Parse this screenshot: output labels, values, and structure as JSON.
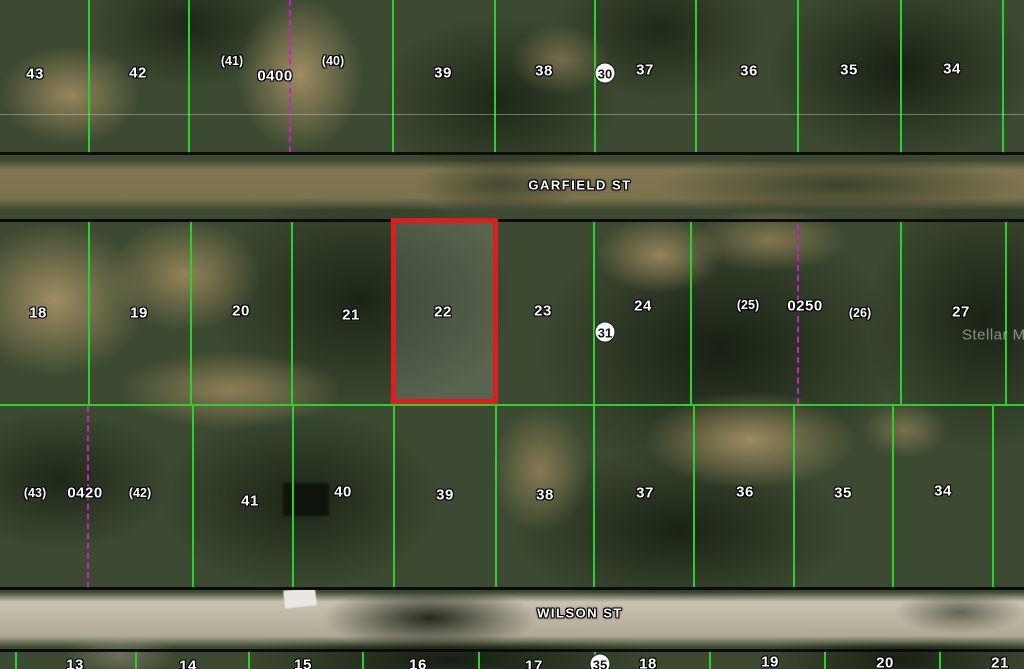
{
  "map": {
    "colors": {
      "parcel_line_green": "#2ccf2b",
      "survey_line_magenta": "#cf1ecb",
      "highlight_red": "#de1e1e",
      "street_line_black": "#0c0c0c"
    },
    "streets": [
      {
        "name": "GARFIELD ST"
      },
      {
        "name": "WILSON ST"
      }
    ],
    "watermark": {
      "text": "Stellar MLS"
    },
    "highlight": {
      "label": "22",
      "x": 391,
      "y": 218,
      "w": 107,
      "h": 186
    },
    "labels": {
      "top_row": [
        {
          "text": "43",
          "x": 35,
          "y": 74
        },
        {
          "text": "42",
          "x": 138,
          "y": 73
        },
        {
          "text": "(41)",
          "x": 232,
          "y": 61
        },
        {
          "text": "0400",
          "x": 275,
          "y": 76
        },
        {
          "text": "(40)",
          "x": 333,
          "y": 61
        },
        {
          "text": "39",
          "x": 443,
          "y": 73
        },
        {
          "text": "38",
          "x": 544,
          "y": 71
        },
        {
          "text": "30",
          "x": 605,
          "y": 73,
          "circled": true
        },
        {
          "text": "37",
          "x": 645,
          "y": 70
        },
        {
          "text": "36",
          "x": 749,
          "y": 71
        },
        {
          "text": "35",
          "x": 849,
          "y": 70
        },
        {
          "text": "34",
          "x": 952,
          "y": 69
        }
      ],
      "middle_row": [
        {
          "text": "18",
          "x": 38,
          "y": 313
        },
        {
          "text": "19",
          "x": 139,
          "y": 313
        },
        {
          "text": "20",
          "x": 241,
          "y": 311
        },
        {
          "text": "21",
          "x": 351,
          "y": 315
        },
        {
          "text": "22",
          "x": 443,
          "y": 312
        },
        {
          "text": "23",
          "x": 543,
          "y": 311
        },
        {
          "text": "31",
          "x": 605,
          "y": 332,
          "circled": true
        },
        {
          "text": "24",
          "x": 643,
          "y": 306
        },
        {
          "text": "(25)",
          "x": 748,
          "y": 305
        },
        {
          "text": "0250",
          "x": 805,
          "y": 306
        },
        {
          "text": "(26)",
          "x": 860,
          "y": 313
        },
        {
          "text": "27",
          "x": 961,
          "y": 312
        }
      ],
      "lower_row": [
        {
          "text": "(43)",
          "x": 35,
          "y": 493
        },
        {
          "text": "0420",
          "x": 85,
          "y": 493
        },
        {
          "text": "(42)",
          "x": 140,
          "y": 493
        },
        {
          "text": "41",
          "x": 250,
          "y": 501
        },
        {
          "text": "40",
          "x": 343,
          "y": 492
        },
        {
          "text": "39",
          "x": 445,
          "y": 495
        },
        {
          "text": "38",
          "x": 545,
          "y": 495
        },
        {
          "text": "37",
          "x": 645,
          "y": 493
        },
        {
          "text": "36",
          "x": 745,
          "y": 492
        },
        {
          "text": "35",
          "x": 843,
          "y": 493
        },
        {
          "text": "34",
          "x": 943,
          "y": 491
        }
      ],
      "bottom_row": [
        {
          "text": "13",
          "x": 75,
          "y": 665
        },
        {
          "text": "14",
          "x": 188,
          "y": 666
        },
        {
          "text": "15",
          "x": 303,
          "y": 665
        },
        {
          "text": "16",
          "x": 418,
          "y": 665
        },
        {
          "text": "17",
          "x": 534,
          "y": 666
        },
        {
          "text": "35",
          "x": 600,
          "y": 664,
          "circled": true
        },
        {
          "text": "18",
          "x": 648,
          "y": 664
        },
        {
          "text": "19",
          "x": 770,
          "y": 662
        },
        {
          "text": "20",
          "x": 885,
          "y": 663
        },
        {
          "text": "21",
          "x": 1000,
          "y": 663
        }
      ]
    },
    "grid": {
      "vlines": [
        {
          "x": 88,
          "y1": 0,
          "y2": 152,
          "style": "green"
        },
        {
          "x": 188,
          "y1": 0,
          "y2": 152,
          "style": "green"
        },
        {
          "x": 392,
          "y1": 0,
          "y2": 152,
          "style": "green"
        },
        {
          "x": 494,
          "y1": 0,
          "y2": 152,
          "style": "green"
        },
        {
          "x": 594,
          "y1": 0,
          "y2": 152,
          "style": "green"
        },
        {
          "x": 695,
          "y1": 0,
          "y2": 152,
          "style": "green"
        },
        {
          "x": 797,
          "y1": 0,
          "y2": 152,
          "style": "green"
        },
        {
          "x": 900,
          "y1": 0,
          "y2": 152,
          "style": "green"
        },
        {
          "x": 1002,
          "y1": 0,
          "y2": 152,
          "style": "green"
        },
        {
          "x": 289,
          "y1": 0,
          "y2": 152,
          "style": "magenta"
        },
        {
          "x": 88,
          "y1": 222,
          "y2": 405,
          "style": "green"
        },
        {
          "x": 190,
          "y1": 222,
          "y2": 405,
          "style": "green"
        },
        {
          "x": 291,
          "y1": 222,
          "y2": 405,
          "style": "green"
        },
        {
          "x": 593,
          "y1": 222,
          "y2": 405,
          "style": "green"
        },
        {
          "x": 690,
          "y1": 222,
          "y2": 405,
          "style": "green"
        },
        {
          "x": 900,
          "y1": 222,
          "y2": 405,
          "style": "green"
        },
        {
          "x": 1005,
          "y1": 222,
          "y2": 405,
          "style": "green"
        },
        {
          "x": 797,
          "y1": 224,
          "y2": 404,
          "style": "magenta"
        },
        {
          "x": 192,
          "y1": 406,
          "y2": 588,
          "style": "green"
        },
        {
          "x": 292,
          "y1": 406,
          "y2": 588,
          "style": "green"
        },
        {
          "x": 393,
          "y1": 406,
          "y2": 588,
          "style": "green"
        },
        {
          "x": 495,
          "y1": 406,
          "y2": 588,
          "style": "green"
        },
        {
          "x": 593,
          "y1": 406,
          "y2": 588,
          "style": "green"
        },
        {
          "x": 693,
          "y1": 406,
          "y2": 588,
          "style": "green"
        },
        {
          "x": 793,
          "y1": 406,
          "y2": 588,
          "style": "green"
        },
        {
          "x": 892,
          "y1": 406,
          "y2": 588,
          "style": "green"
        },
        {
          "x": 992,
          "y1": 406,
          "y2": 588,
          "style": "green"
        },
        {
          "x": 87,
          "y1": 406,
          "y2": 588,
          "style": "magenta"
        },
        {
          "x": 15,
          "y1": 651,
          "y2": 669,
          "style": "green"
        },
        {
          "x": 135,
          "y1": 651,
          "y2": 669,
          "style": "green"
        },
        {
          "x": 248,
          "y1": 651,
          "y2": 669,
          "style": "green"
        },
        {
          "x": 362,
          "y1": 651,
          "y2": 669,
          "style": "green"
        },
        {
          "x": 478,
          "y1": 651,
          "y2": 669,
          "style": "green"
        },
        {
          "x": 594,
          "y1": 651,
          "y2": 669,
          "style": "green"
        },
        {
          "x": 709,
          "y1": 651,
          "y2": 669,
          "style": "green"
        },
        {
          "x": 824,
          "y1": 651,
          "y2": 669,
          "style": "green"
        },
        {
          "x": 939,
          "y1": 651,
          "y2": 669,
          "style": "green"
        }
      ],
      "hlines": [
        {
          "y": 114,
          "x1": 0,
          "x2": 1024,
          "style": "faint"
        },
        {
          "y": 152,
          "x1": 0,
          "x2": 1024,
          "style": "black"
        },
        {
          "y": 219,
          "x1": 0,
          "x2": 1024,
          "style": "black"
        },
        {
          "y": 404,
          "x1": 0,
          "x2": 1024,
          "style": "green"
        },
        {
          "y": 587,
          "x1": 0,
          "x2": 1024,
          "style": "black"
        },
        {
          "y": 649,
          "x1": 0,
          "x2": 1024,
          "style": "black"
        }
      ]
    }
  }
}
